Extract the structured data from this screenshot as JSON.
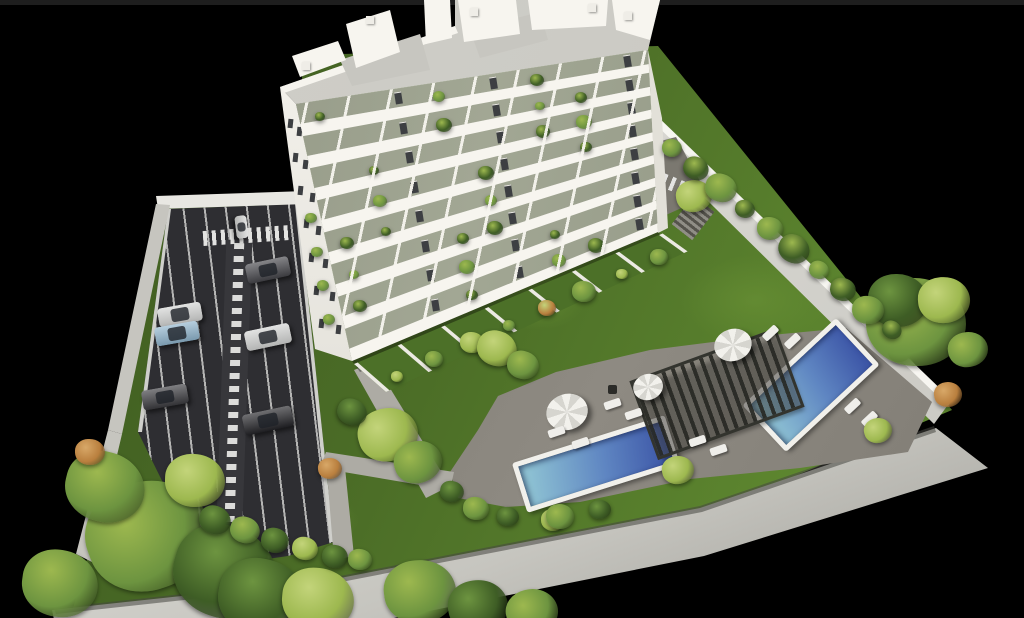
{
  "scene": {
    "description": "aerial-3d-architectural-render-of-white-apartment-building-with-garden-two-pools-pergola-and-parking-lot-on-black-background",
    "background": "#000000",
    "top_strip_color": "#1e1e1e"
  },
  "colors": {
    "grass_dark": "#3f5c20",
    "grass_mid": "#4a6b26",
    "grass_bright": "#5d862f",
    "asphalt": "#2e2e32",
    "asphalt_lane": "#37373b",
    "stall_line": "#dcdcda",
    "wall_top": "#e8e7e2",
    "wall_face": "#c6c5bf",
    "wall_shade": "#9c9b95",
    "building": "#f3f1ea",
    "building_shade": "#e2e0d8",
    "glass": "#a2a794",
    "glass_dark": "#8a8f7d",
    "window": "#3d3f42",
    "roof": "#d0cfc9",
    "roof_terrace": "#c7c6c0",
    "deck": "#7e7a72",
    "deck_light": "#8e8a82",
    "path": "#adaba4",
    "pool_rim": "#f1f0eb",
    "pool_light": "#8ec2d3",
    "pool_deep": "#3e58a8",
    "pergola": "#33342e",
    "hedge": "#3e5d25",
    "palm": "#6d9440",
    "palm_light": "#9db84f",
    "bush_orange": "#b97f3e",
    "car_white": "#d3d4d3",
    "car_blue": "#8fb4cc",
    "car_dark": "#45454a",
    "car_black": "#232327",
    "umbrella": "#f2f1ec",
    "lounger": "#efeeea"
  },
  "inventory": {
    "building_floors": 8,
    "parked_cars": 7,
    "driveway_cars": 1,
    "pools": 2,
    "pergolas": 1,
    "umbrellas": 3,
    "sun_loungers": 10
  }
}
